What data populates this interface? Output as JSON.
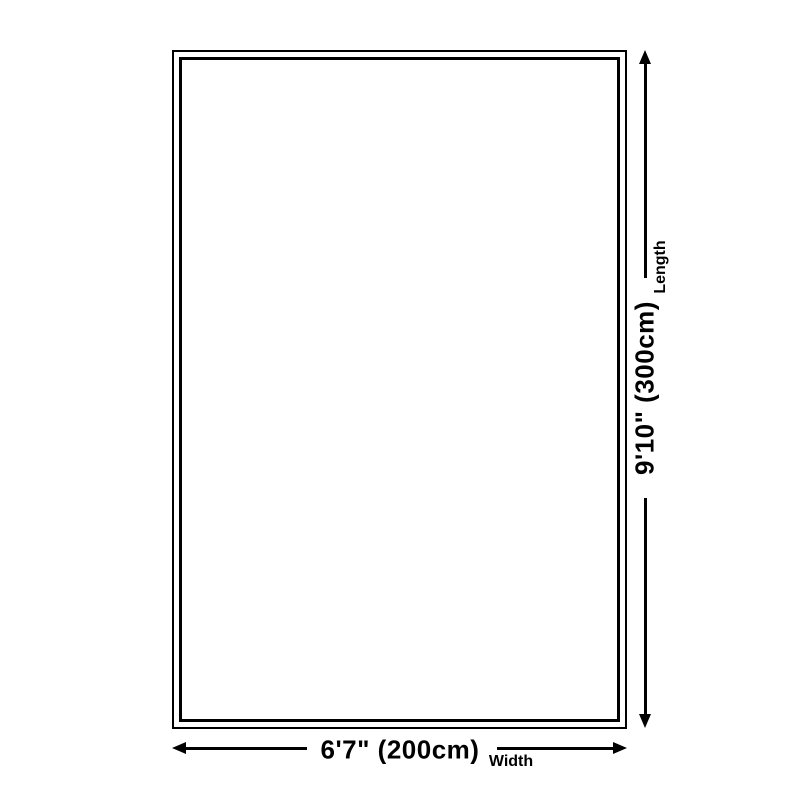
{
  "page": {
    "background_color": "#ffffff",
    "line_color": "#000000"
  },
  "diagram": {
    "kind": "rug-size-dimension-diagram",
    "width": {
      "value": "6'7\" (200cm)",
      "axis_label": "Width"
    },
    "length": {
      "value": "9'10\" (300cm)",
      "axis_label": "Length"
    }
  }
}
